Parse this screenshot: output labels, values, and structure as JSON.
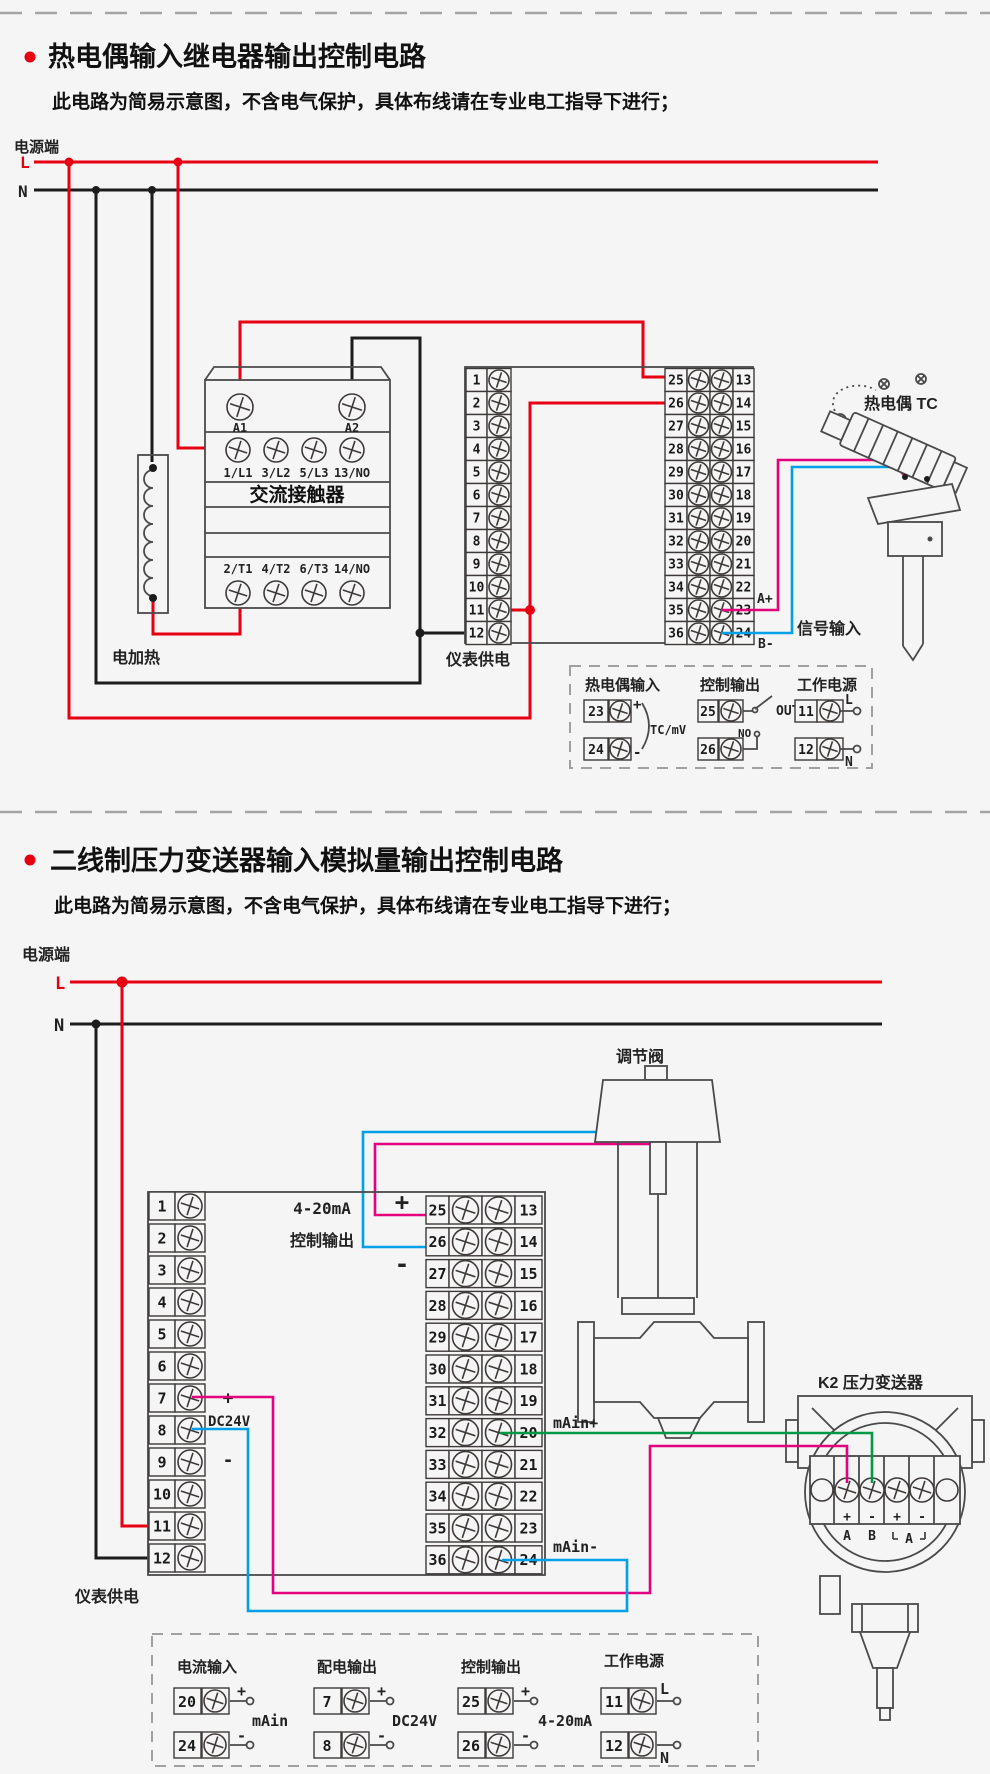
{
  "colors": {
    "live_wire": "#e60012",
    "neutral_wire": "#1c1c1c",
    "signal_positive": "#e4007f",
    "signal_negative": "#00a0e9",
    "current_loop": "#009944",
    "background": "#f5f5f5"
  },
  "section1": {
    "title": "热电偶输入继电器输出控制电路",
    "subtitle": "此电路为简易示意图，不含电气保护，具体布线请在专业电工指导下进行；",
    "power_terminal_label": "电源端",
    "l_label": "L",
    "n_label": "N",
    "heater_label": "电加热",
    "instrument_power_label": "仪表供电",
    "thermocouple_label": "热电偶 TC",
    "contactor": {
      "label": "交流接触器",
      "coil_a1": "A1",
      "coil_a2": "A2",
      "input_terminals": [
        "1/L1",
        "3/L2",
        "5/L3",
        "13/NO"
      ],
      "output_terminals": [
        "2/T1",
        "4/T2",
        "6/T3",
        "14/NO"
      ]
    },
    "terminal_numbers": {
      "left": [
        "1",
        "2",
        "3",
        "4",
        "5",
        "6",
        "7",
        "8",
        "9",
        "10",
        "11",
        "12"
      ],
      "middle": [
        "25",
        "26",
        "27",
        "28",
        "29",
        "30",
        "31",
        "32",
        "33",
        "34",
        "35",
        "36"
      ],
      "right": [
        "13",
        "14",
        "15",
        "16",
        "17",
        "18",
        "19",
        "20",
        "21",
        "22",
        "23",
        "24"
      ]
    },
    "wire_labels": {
      "a_plus": "A+",
      "b_minus": "B-",
      "signal_input": "信号输入"
    },
    "legend": {
      "group1": {
        "title": "热电偶输入",
        "row1_num": "23",
        "row1_sign": "+",
        "row2_num": "24",
        "row2_sign": "-",
        "note": "TC/mV"
      },
      "group2": {
        "title": "控制输出",
        "row1_num": "25",
        "row2_num": "26",
        "no_label": "NO",
        "out_label": "OUT"
      },
      "group3": {
        "title": "工作电源",
        "row1_num": "11",
        "row1_sign": "L",
        "row2_num": "12",
        "row2_sign": "N"
      }
    }
  },
  "section2": {
    "title": "二线制压力变送器输入模拟量输出控制电路",
    "subtitle": "此电路为简易示意图，不含电气保护，具体布线请在专业电工指导下进行；",
    "power_terminal_label": "电源端",
    "l_label": "L",
    "n_label": "N",
    "valve_label": "调节阀",
    "transmitter_label": "K2 压力变送器",
    "transmitter_signs": [
      "+",
      "-",
      "+",
      "-"
    ],
    "transmitter_letters": [
      "A",
      "B",
      "A"
    ],
    "output_label_line1": "4-20mA",
    "output_label_line2": "控制输出",
    "output_plus": "+",
    "output_minus": "-",
    "dc24v_plus": "+",
    "dc24v_label": "DC24V",
    "dc24v_minus": "-",
    "main_plus": "mAin+",
    "main_minus": "mAin-",
    "instrument_power_label": "仪表供电",
    "terminal_numbers": {
      "left": [
        "1",
        "2",
        "3",
        "4",
        "5",
        "6",
        "7",
        "8",
        "9",
        "10",
        "11",
        "12"
      ],
      "middle": [
        "25",
        "26",
        "27",
        "28",
        "29",
        "30",
        "31",
        "32",
        "33",
        "34",
        "35",
        "36"
      ],
      "right": [
        "13",
        "14",
        "15",
        "16",
        "17",
        "18",
        "19",
        "20",
        "21",
        "22",
        "23",
        "24"
      ]
    },
    "legend": {
      "group1": {
        "title": "电流输入",
        "row1_num": "20",
        "row1_sign": "+",
        "row2_num": "24",
        "row2_sign": "-",
        "note": "mAin"
      },
      "group2": {
        "title": "配电输出",
        "row1_num": "7",
        "row1_sign": "+",
        "row2_num": "8",
        "row2_sign": "-",
        "note": "DC24V"
      },
      "group3": {
        "title": "控制输出",
        "row1_num": "25",
        "row1_sign": "+",
        "row2_num": "26",
        "row2_sign": "-",
        "note": "4-20mA"
      },
      "group4": {
        "title": "工作电源",
        "row1_num": "11",
        "row1_sign": "L",
        "row2_num": "12",
        "row2_sign": "N"
      }
    }
  }
}
